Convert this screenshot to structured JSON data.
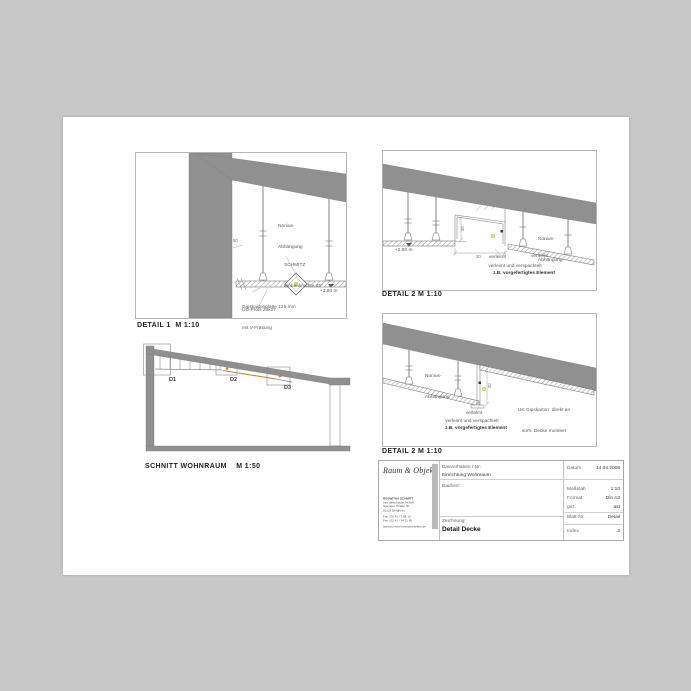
{
  "colors": {
    "canvas_bg": "#c8c8c8",
    "sheet": "#ffffff",
    "concrete_gray": "#909090",
    "accent_orange": "#c8823c",
    "light_yellow": "#e8e550"
  },
  "panels": {
    "detail1": {
      "title": "DETAIL 1  M 1:10",
      "labels": {
        "nonius_line1": "Nonius-",
        "nonius_line2": "Abhängung",
        "dim_50": "50",
        "schmitz_line1": "SCHMITZ",
        "schmitz_line2": "Einbauleuchte 45°",
        "gips_line1": "Gipskartonplatte 125 mm",
        "gips_line2": "mit V-Fräsung",
        "elevation": "+2,80 m",
        "ud_profil": "UD-Profil 28x27"
      }
    },
    "detail2": {
      "title": "DETAIL 2 M 1:10",
      "labels": {
        "elevation": "+2,80 m",
        "dim_v": "20",
        "dim_h": "20",
        "nonius_line1": "Nonius-",
        "nonius_line2": "Abhängung",
        "note_verleimt_left": "verleimt",
        "note_verleimt_right": "verleimt",
        "note_line2": "verleimt und verspachtelt",
        "note_line3": "z.B. vorgefertigtes Element"
      }
    },
    "detail3": {
      "title": "DETAIL 2 M 1:10",
      "labels": {
        "nonius_line1": "Nonius-",
        "nonius_line2": "Abhängung",
        "uk_line1": "UK Gipskarton  direkt an",
        "uk_line2": "vorh. Decke montiert",
        "dim_v": "20",
        "note_verleimt": "verleimt",
        "note_line2": "verleimt und verspachtelt",
        "note_line3": "z.B. vorgefertigtes Element"
      }
    },
    "schnitt": {
      "title": "SCHNITT WOHNRAUM    M 1:50",
      "markers": {
        "d1": "D1",
        "d2": "D2",
        "d3": "D3"
      }
    }
  },
  "titleblock": {
    "logo": "Raum & Objekt",
    "address": [
      "ROSWITHA SCHMITT",
      "Innenarchitektin AKNW",
      "Speyerer Straße 40",
      "50129 Bergheim"
    ],
    "contact": [
      "Fon | 02 41 / 7 88 10",
      "Fax | 02 41 / 74 31 50"
    ],
    "web": "www.schmitt-innenarchitektur.de",
    "fields": {
      "bauvorhaben_label": "Bauvorhaben / Nr:",
      "bauvorhaben_value": "Einrichtung Wohnraum",
      "bauherr_label": "Bauherr:",
      "zeichnung_label": "Zeichnung:",
      "zeichnung_value": "Detail Decke",
      "datum_label": "Datum",
      "datum_value": "14.04.2008",
      "massstab_label": "Maßstab",
      "massstab_value": "1:10",
      "format_label": "Format",
      "format_value": "Din A3",
      "gez_label": "gez.",
      "gez_value": "ast",
      "blatt_label": "Blatt-Nr:",
      "blatt_value": "Detail",
      "index_label": "Index",
      "index_value": ".2"
    }
  }
}
